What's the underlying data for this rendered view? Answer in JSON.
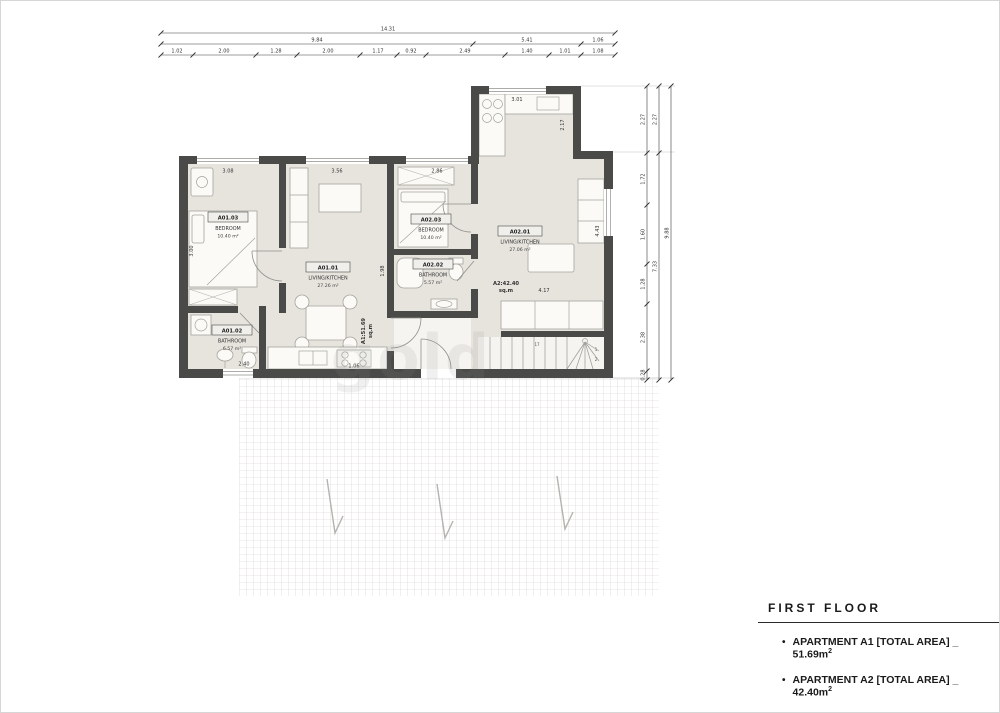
{
  "watermark": "gold",
  "dims_top": {
    "total": "14.31",
    "row2": [
      "9.84",
      "5.41",
      "1.06"
    ],
    "row3": [
      "1.02",
      "2.00",
      "1.28",
      "2.00",
      "1.17",
      "0.92",
      "2.49",
      "1.40",
      "1.01",
      "1.08"
    ]
  },
  "dims_right": {
    "inner": [
      "2.27",
      "1.72",
      "1.60",
      "1.28",
      "2.38",
      "0.28"
    ],
    "middle": [
      "2.27",
      "7.33"
    ],
    "outer": "9.88"
  },
  "dims_inner": {
    "bedroom1_window": "3.08",
    "living_window": "3.56",
    "bedroom2_window": "2.86",
    "kitchen_top": "3.01",
    "kitchen_side": "2.17",
    "living_side": "1.98",
    "hall_width": "4.17",
    "living2_side": "4.43",
    "bath_width": "2.40",
    "stove_width": "1.06",
    "wardrobe_side": "3.00"
  },
  "rooms": [
    {
      "code": "A01.03",
      "name": "BEDROOM",
      "area": "10.40 m²"
    },
    {
      "code": "A01.01",
      "name": "LIVING/KITCHEN",
      "area": "27.26 m²"
    },
    {
      "code": "A01.02",
      "name": "BATHROOM",
      "area": "6.57 m²"
    },
    {
      "code": "A02.03",
      "name": "BEDROOM",
      "area": "10.40 m²"
    },
    {
      "code": "A02.02",
      "name": "BATHROOM",
      "area": "5.57 m²"
    },
    {
      "code": "A02.01",
      "name": "LIVING/KITCHEN",
      "area": "27.06 m²"
    }
  ],
  "apartment_tags": [
    {
      "value": "A1:51.69",
      "unit": "sq.m"
    },
    {
      "value": "A2:42.40",
      "unit": "sq.m"
    }
  ],
  "stairs": {
    "top_step": "17",
    "step_one": "1",
    "step_two": "2"
  },
  "legend": {
    "title": "FIRST FLOOR",
    "items": [
      {
        "bullet": "•",
        "text": "APARTMENT A1 [TOTAL AREA] _ 51.69m",
        "sup": "2"
      },
      {
        "bullet": "•",
        "text": "APARTMENT A2 [TOTAL AREA] _ 42.40m",
        "sup": "2"
      }
    ]
  },
  "colors": {
    "wall": "#4a4a48",
    "floor": "#e7e4de",
    "accent_text": "#1a1a1a"
  }
}
